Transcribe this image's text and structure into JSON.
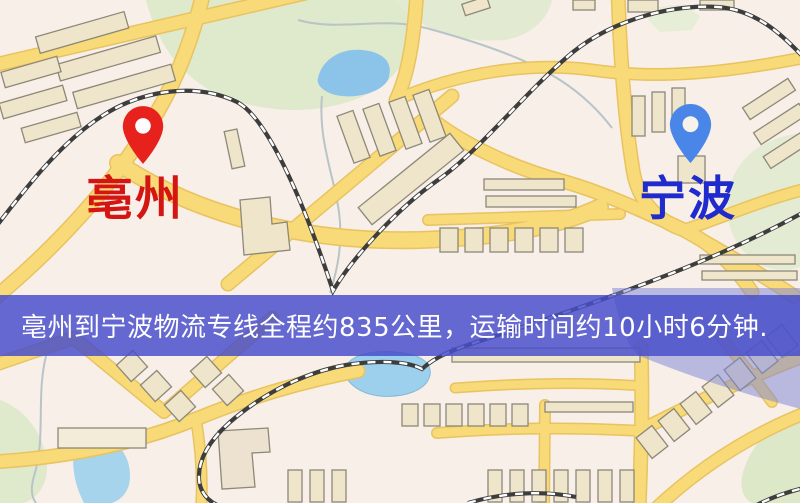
{
  "map": {
    "markers": {
      "origin": {
        "name": "亳州",
        "pin_color": "#e7211b",
        "label_color": "#d41511",
        "pin_icon": "red-location-pin"
      },
      "destination": {
        "name": "宁波",
        "pin_color": "#4a86e8",
        "label_color": "#1f2bcd",
        "pin_icon": "blue-location-pin"
      }
    },
    "banner": {
      "text": "亳州到宁波物流专线全程约835公里，运输时间约10小时6分钟.",
      "route": "亳州到宁波物流专线",
      "distance": "约835公里",
      "duration": "约10小时6分钟",
      "background_color": "#4d52cd",
      "text_color": "#ffffff"
    },
    "legend_colors": {
      "land": "#f7efe8",
      "road": "#f8da79",
      "road_casing": "#e8c35f",
      "park": "#dfe9cb",
      "water": "#8fc6e9",
      "building": "#efe5ca",
      "building_outline": "#8d8879",
      "railway": "#3d3d3d",
      "river_overlay": "#7b84d8"
    }
  }
}
